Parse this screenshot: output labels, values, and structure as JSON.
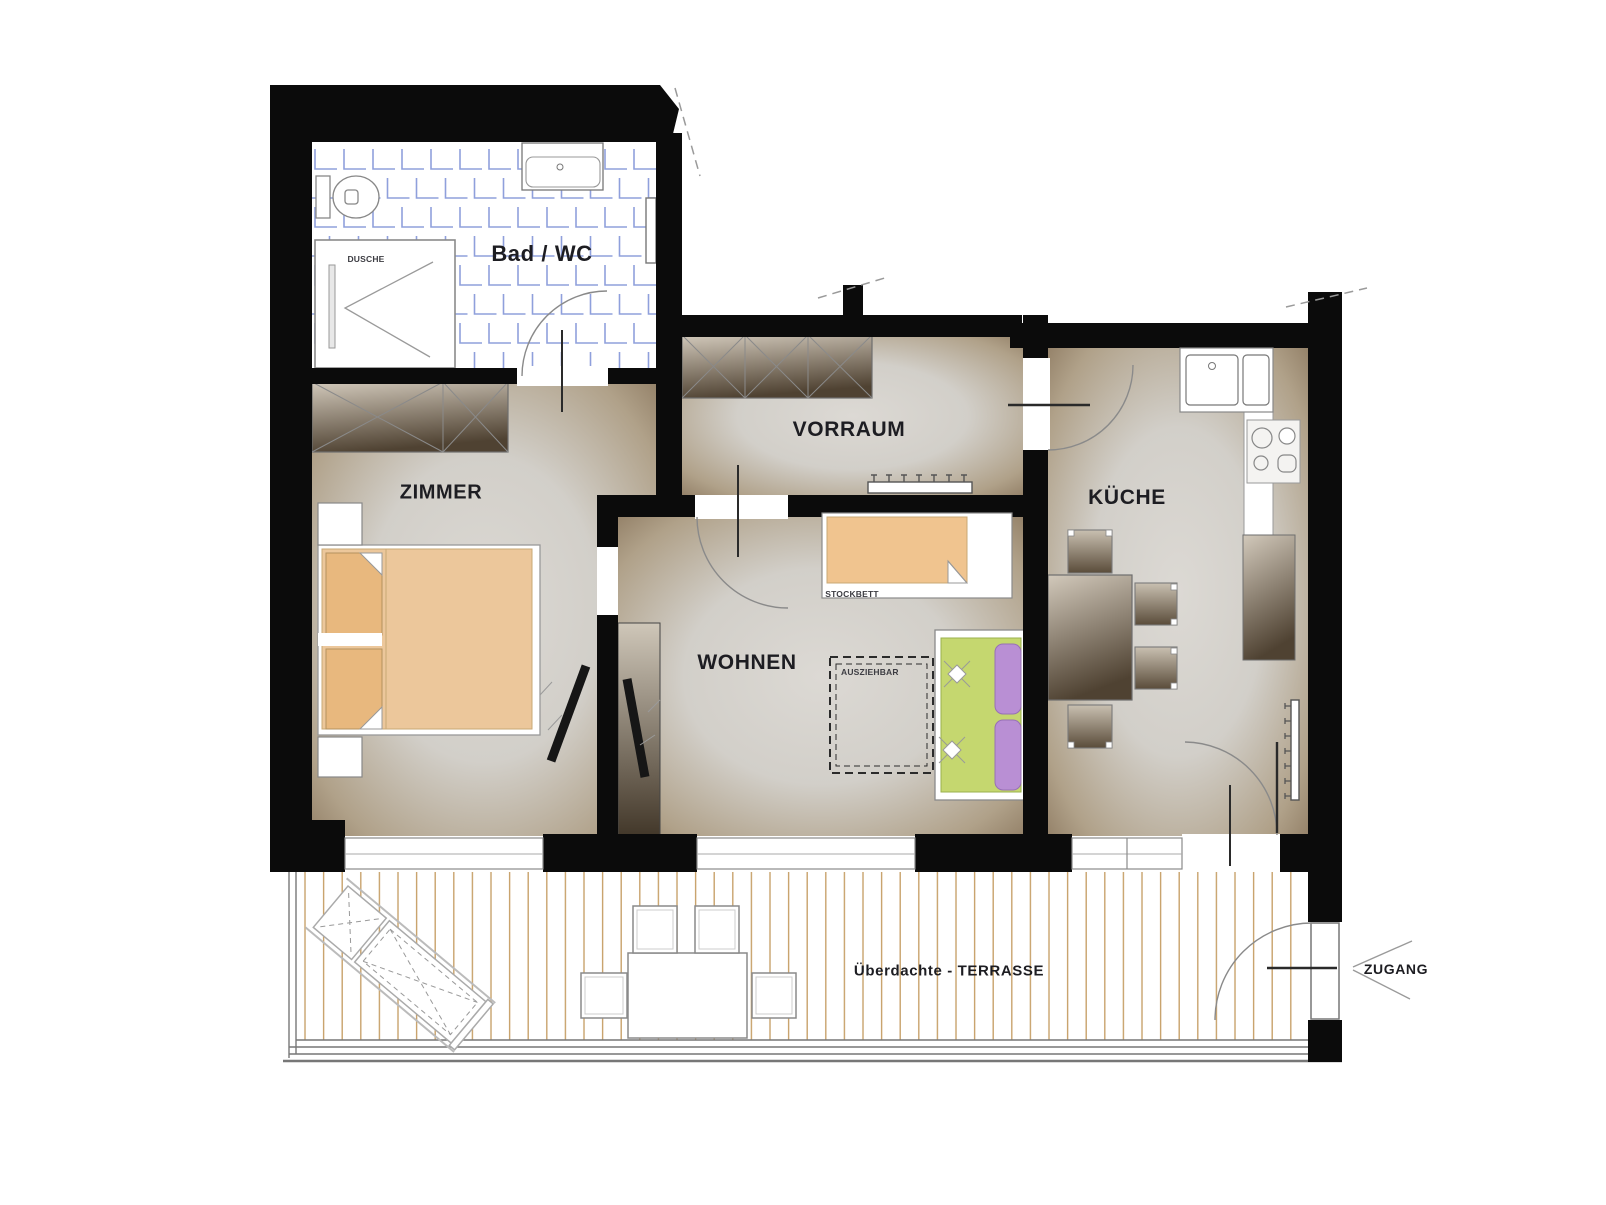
{
  "labels": {
    "bad_wc": "Bad / WC",
    "dusche": "DUSCHE",
    "zimmer": "ZIMMER",
    "vorraum": "VORRAUM",
    "wohnen": "WOHNEN",
    "kueche": "KÜCHE",
    "stockbett": "STOCKBETT",
    "ausziehbar": "AUSZIEHBAR",
    "terrasse": "Überdachte - TERRASSE",
    "zugang": "ZUGANG"
  },
  "colors": {
    "wall": "#0b0b0b",
    "tile_grid": "#8fa0dc",
    "room_edge": "#8a765d",
    "room_center": "#dcd9d4",
    "furniture_dark": "#4f4232",
    "furniture_light": "#d2c9bb",
    "bed_orange": "#ecc79b",
    "pillow_orange": "#e8b87e",
    "bunkbed_orange": "#f0c48f",
    "sofa_green": "#c5d76f",
    "sofa_purple": "#b98fd4",
    "deck_line": "#c8a26b"
  }
}
